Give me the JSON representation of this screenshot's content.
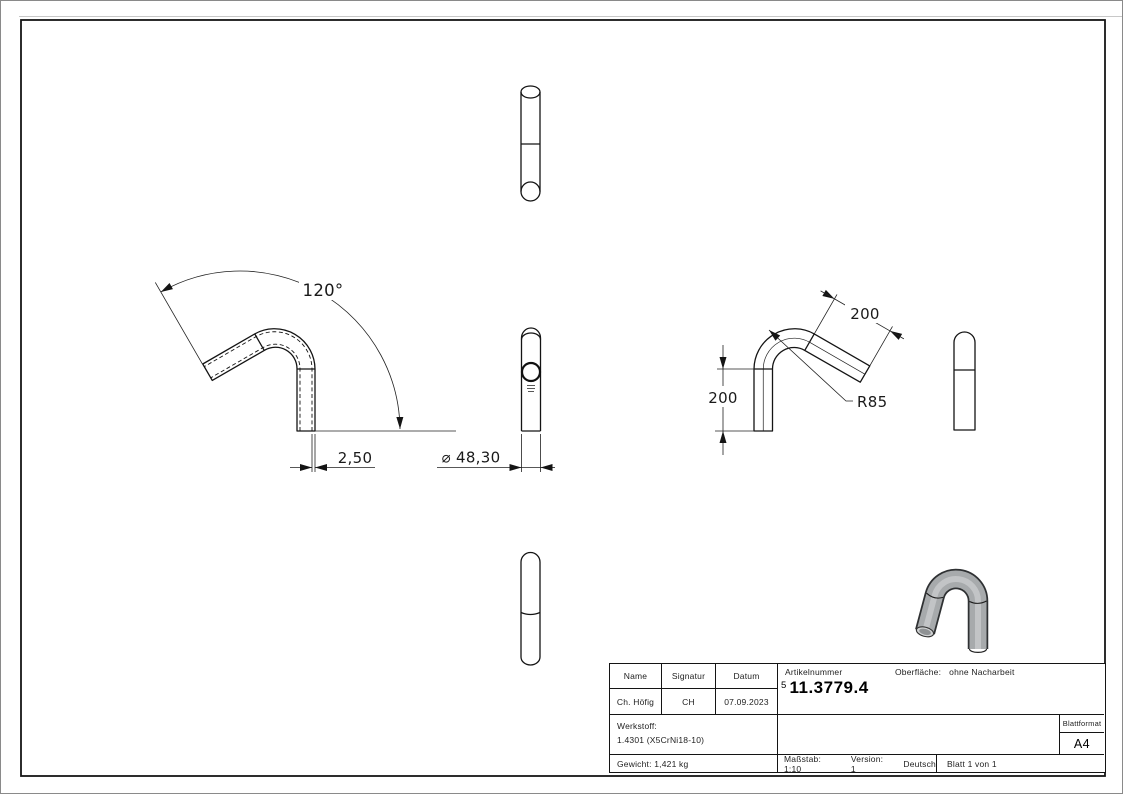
{
  "sheet": {
    "dimensions": {
      "angle": "120°",
      "wall_thickness": "2,50",
      "diameter": "⌀ 48,30",
      "leg_length_vertical": "200",
      "leg_length_angled": "200",
      "bend_radius": "R85"
    },
    "title_block": {
      "headers": {
        "name": "Name",
        "signatur": "Signatur",
        "datum": "Datum",
        "artikelnummer": "Artikelnummer",
        "oberflaeche_label": "Oberfläche:",
        "oberflaeche_value": "ohne Nacharbeit"
      },
      "values": {
        "name": "Ch. Höfig",
        "signatur": "CH",
        "datum": "07.09.2023",
        "artikel_prefix": "5",
        "artikelnummer": "11.3779.4"
      },
      "werkstoff_label": "Werkstoff:",
      "werkstoff_value": "1.4301 (X5CrNi18-10)",
      "blattformat_label": "Blattformat",
      "blattformat_value": "A4",
      "footer": {
        "gewicht": "Gewicht: 1,421 kg",
        "massstab": "Maßstab: 1:10",
        "version": "Version: 1",
        "sprache": "Deutsch",
        "blatt": "Blatt 1 von 1"
      }
    }
  },
  "colors": {
    "line": "#141414",
    "metal_mid": "#a7aaac",
    "metal_light": "#c5c7c9",
    "metal_dark": "#2f3133",
    "paper": "#ffffff"
  }
}
